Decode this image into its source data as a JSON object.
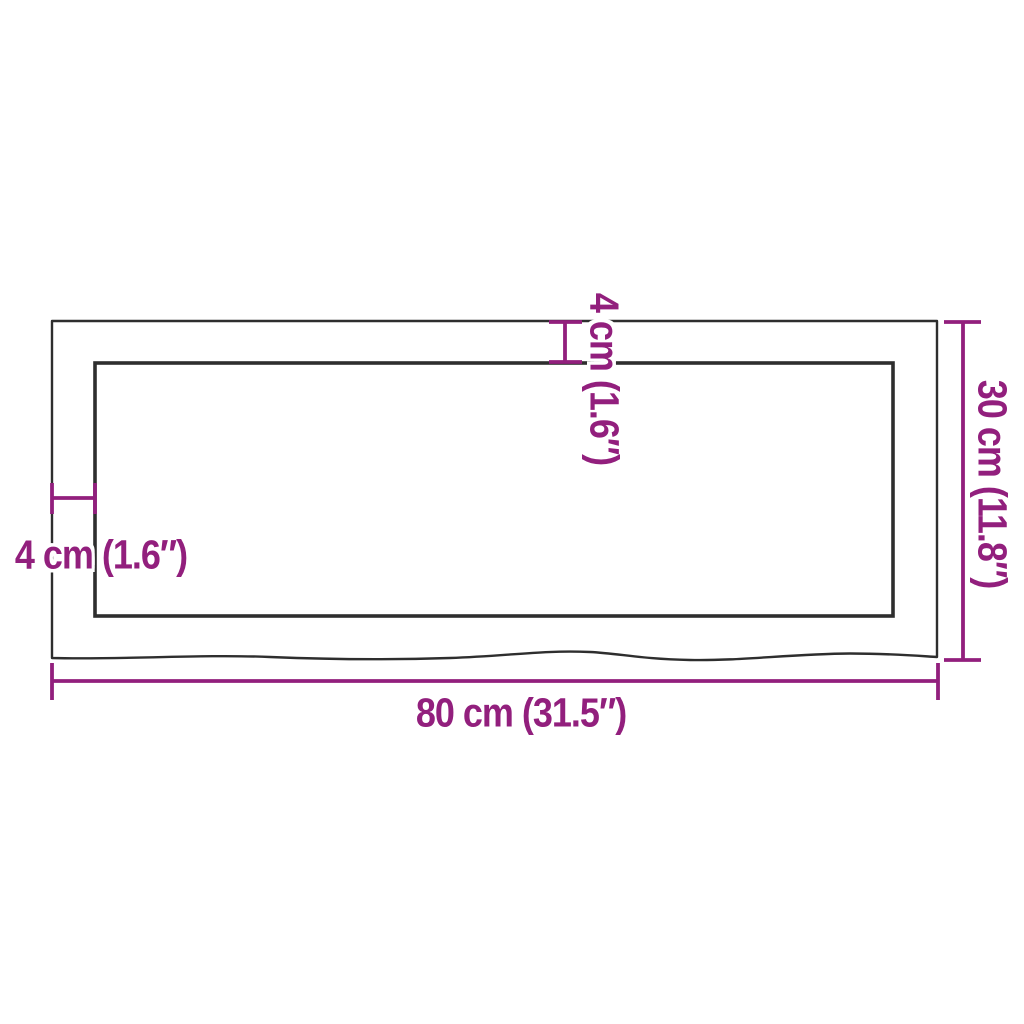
{
  "diagram": {
    "kind": "product-dimension-diagram",
    "shape": "rectangular panel with wavy (live) bottom edge",
    "labels": {
      "width": "80 cm (31.5″)",
      "height": "30 cm (11.8″)",
      "thickness_top": "4 cm (1.6″)",
      "thickness_left": "4 cm (1.6″)"
    },
    "values": {
      "width_cm": 80,
      "width_in": 31.5,
      "height_cm": 30,
      "height_in": 11.8,
      "thickness_cm": 4,
      "thickness_in": 1.6
    },
    "colors": {
      "dimension_annotation": "#921F7D",
      "outline": "#2e2e2e",
      "background": "#ffffff"
    }
  }
}
